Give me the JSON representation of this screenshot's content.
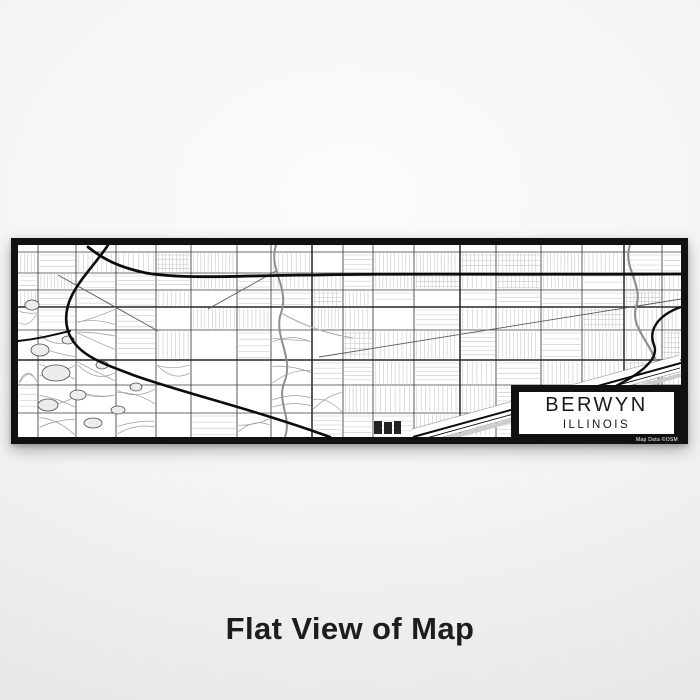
{
  "product_image": {
    "alt": "Flat View of Map of Berwyn Illinois in Classic style",
    "map": {
      "city": "BERWYN",
      "state": "ILLINOIS",
      "credit": "Map Data ©OSM"
    },
    "caption": "Flat View of Map",
    "colors": {
      "page_bg": "#f1f1f1",
      "frame": "#111111",
      "map_bg": "#ffffff",
      "fine_street": "#c3c3c3",
      "suburb_street": "#9a9a9a",
      "arterial": "#3f3f3f",
      "arterial_bold": "#262626",
      "highway": "#0c0c0c",
      "water": "#8f8f8f",
      "pond_fill": "#ececec",
      "pond_edge": "#4a4a4a",
      "rail_edge": "#999999",
      "canal": "#cccccc",
      "caption_text": "#1d1d1d"
    }
  }
}
